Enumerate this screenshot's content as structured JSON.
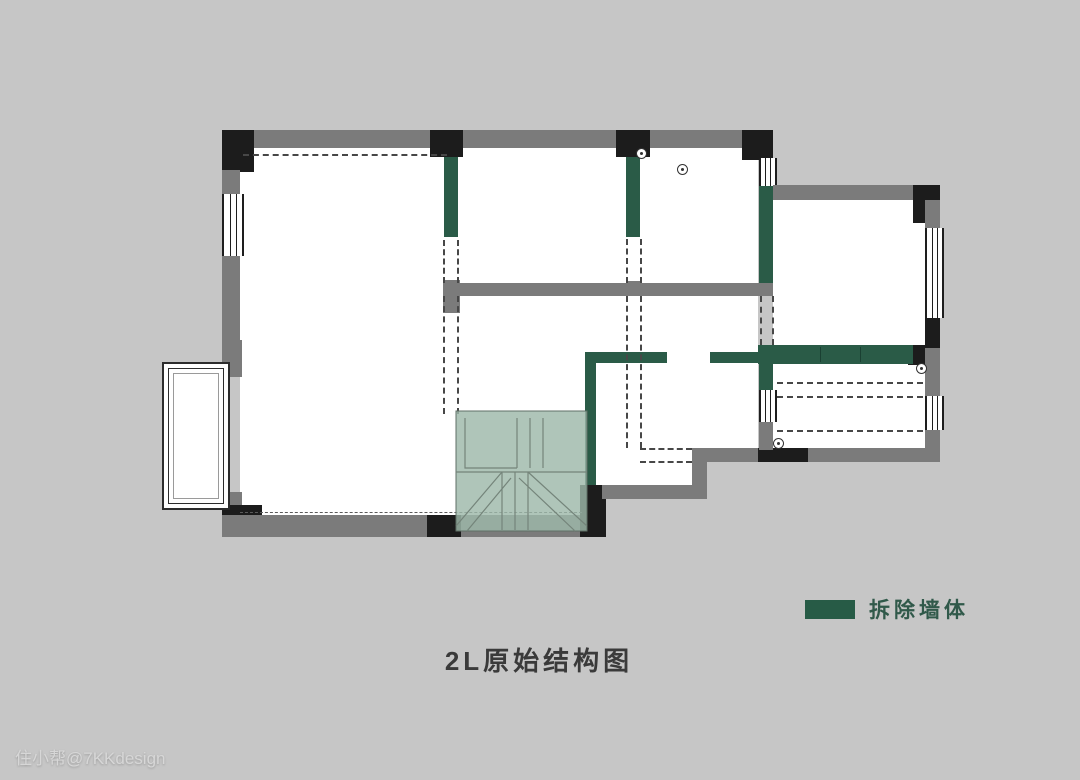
{
  "title": {
    "text": "2L原始结构图"
  },
  "legend": {
    "label": "拆除墙体",
    "swatch_color": "#275B46"
  },
  "watermark": {
    "text": "住小帮@7KKdesign"
  },
  "colors": {
    "background": "#C6C6C6",
    "wall_gray": "#7B7B7B",
    "wall_black": "#1C1C1C",
    "demolish_green": "#2A5B47",
    "stair_overlay": "#9DB8A9",
    "room_white": "#FFFFFF"
  }
}
